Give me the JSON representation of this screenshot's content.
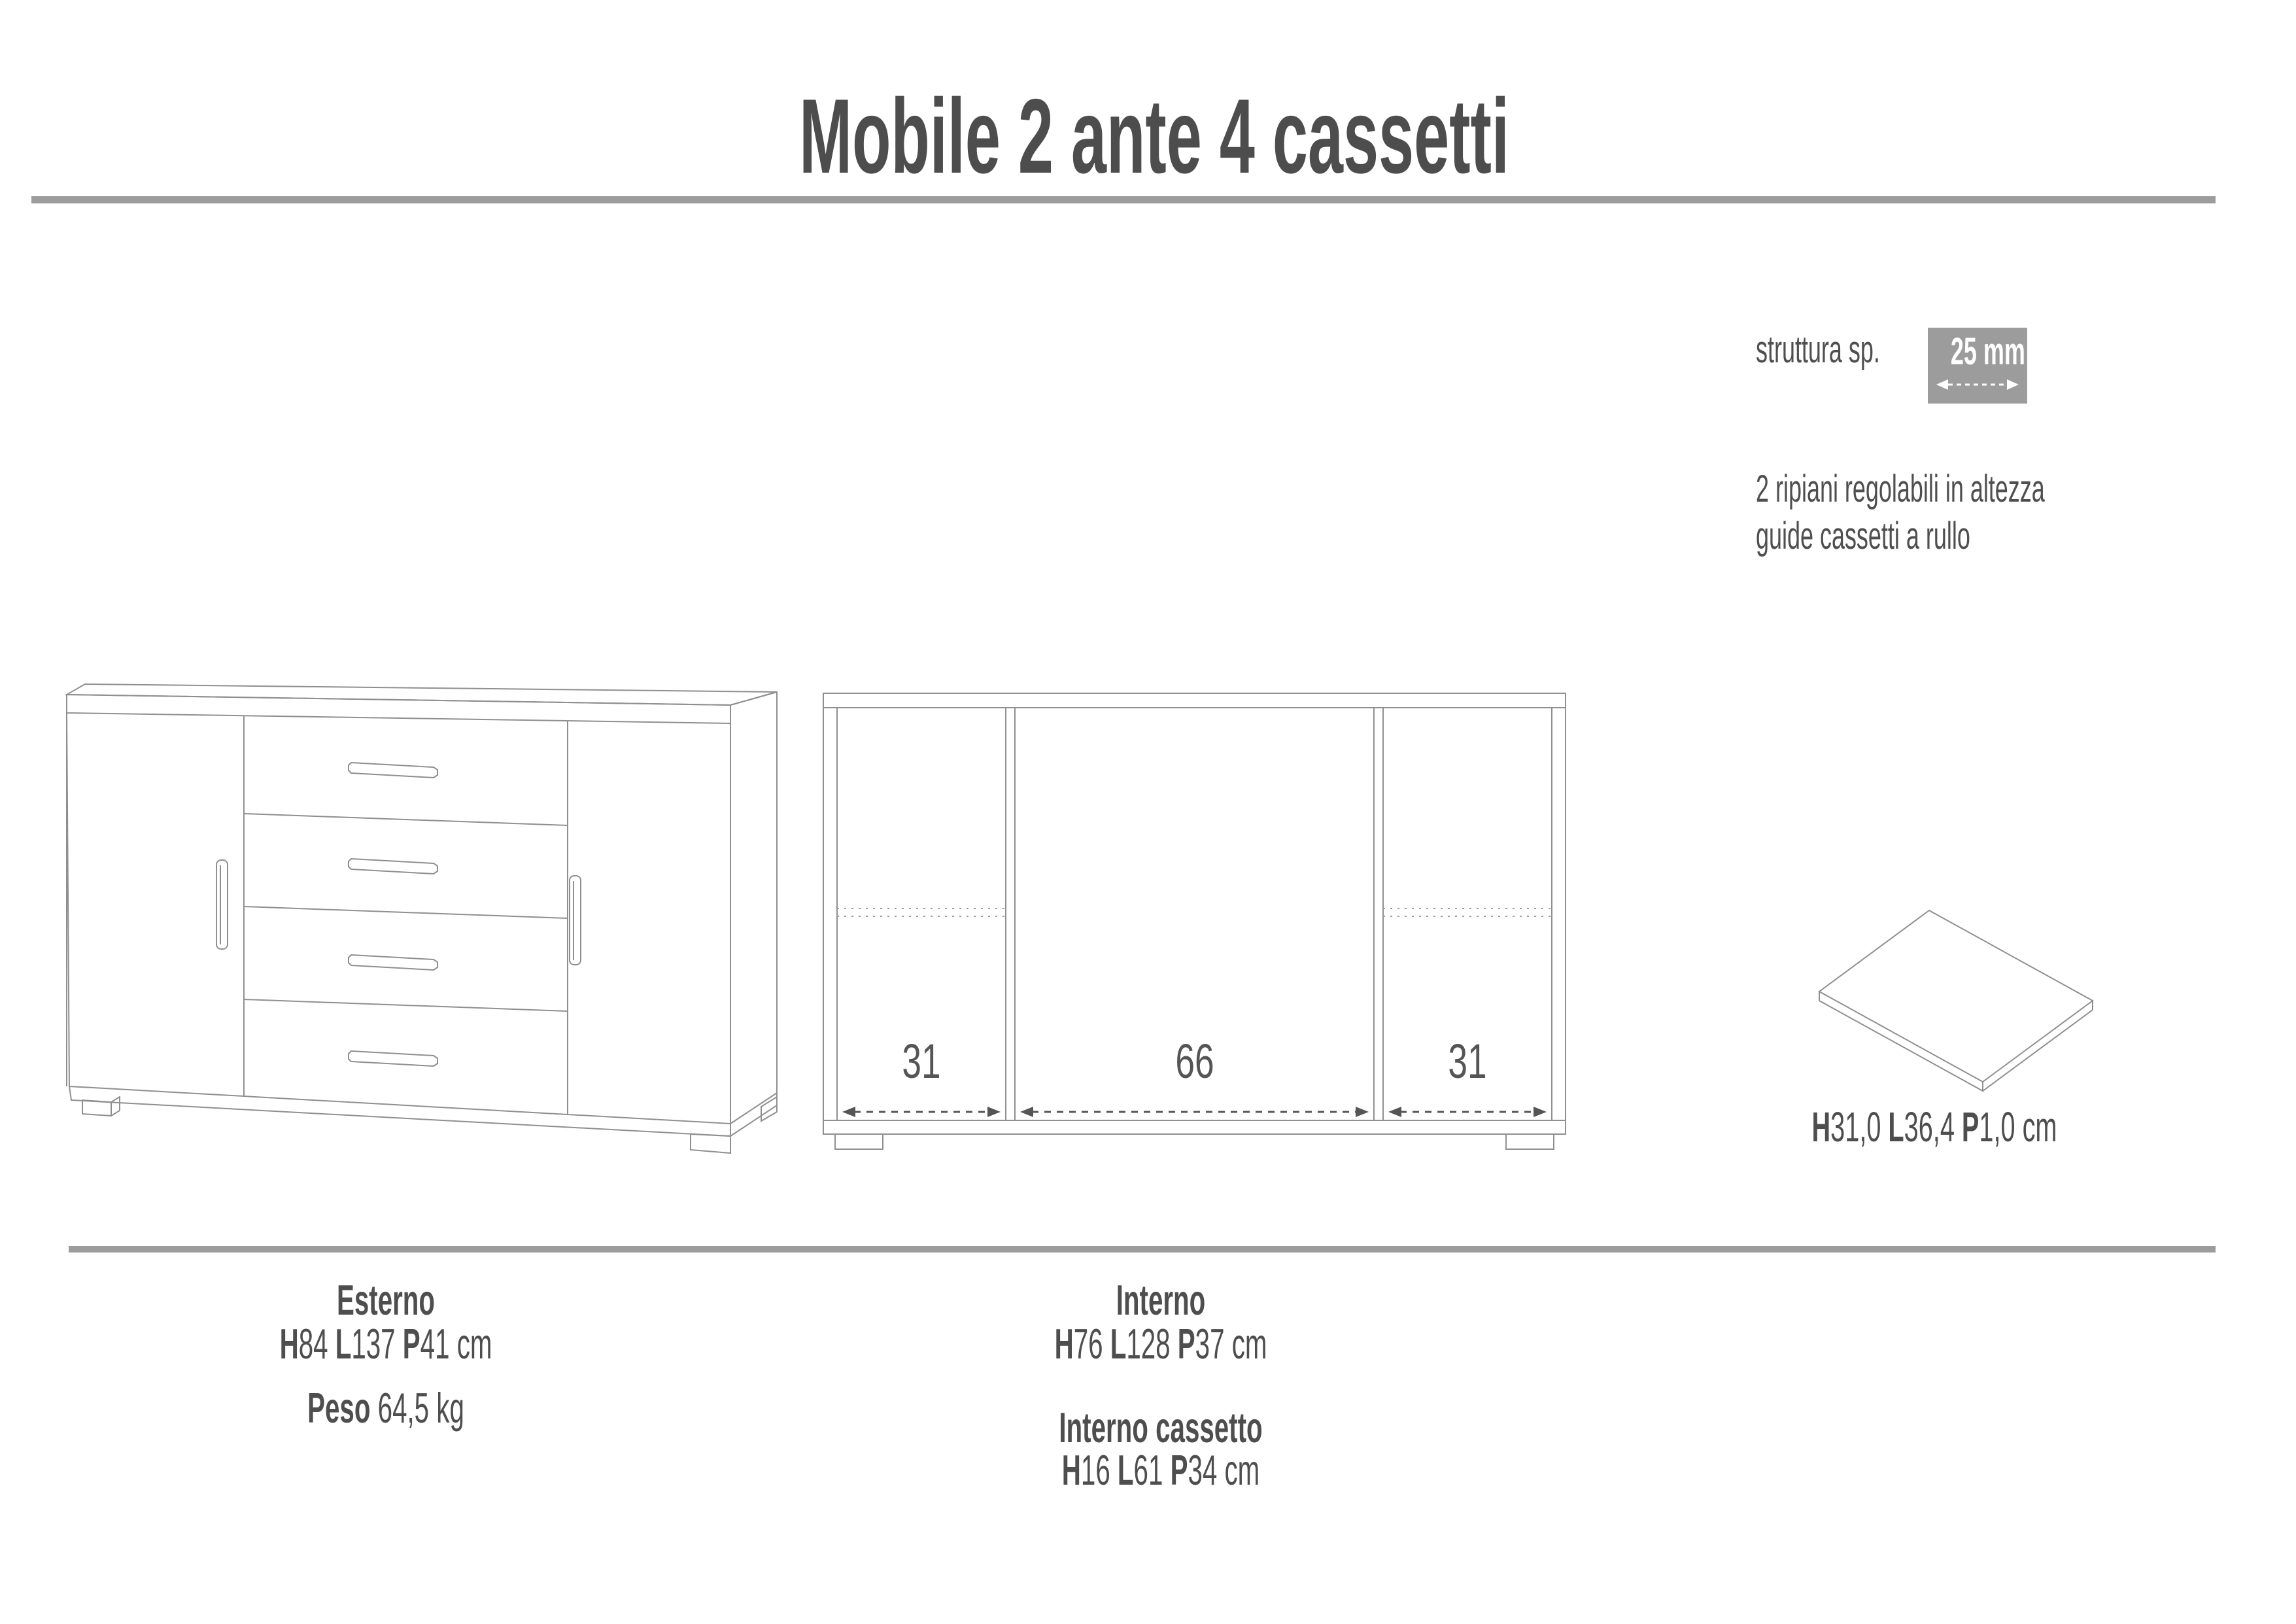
{
  "page": {
    "background": "#ffffff",
    "rule_color": "#9c9c9c",
    "text_color": "#4e4e4e",
    "drawing_line_color": "#8f8f8f",
    "badge_color": "#9c9c9c"
  },
  "title": "Mobile 2 ante 4 cassetti",
  "structure": {
    "label": "struttura sp.",
    "thickness": "25 mm"
  },
  "features": {
    "line1": "2 ripiani regolabili in altezza",
    "line2": "guide cassetti a rullo"
  },
  "internal_widths": [
    "31",
    "66",
    "31"
  ],
  "shelf": {
    "dims": [
      {
        "b": "H"
      },
      {
        "t": "31,0 "
      },
      {
        "b": "L"
      },
      {
        "t": "36,4 "
      },
      {
        "b": "P"
      },
      {
        "t": "1,0 cm"
      }
    ]
  },
  "specs": {
    "esterno": {
      "heading": "Esterno",
      "dims": [
        {
          "b": "H"
        },
        {
          "t": "84 "
        },
        {
          "b": "L"
        },
        {
          "t": "137 "
        },
        {
          "b": "P"
        },
        {
          "t": "41 cm"
        }
      ],
      "weight": [
        {
          "b": "Peso "
        },
        {
          "t": "64,5 kg"
        }
      ]
    },
    "interno": {
      "heading": "Interno",
      "dims": [
        {
          "b": "H"
        },
        {
          "t": "76 "
        },
        {
          "b": "L"
        },
        {
          "t": "128 "
        },
        {
          "b": "P"
        },
        {
          "t": "37 cm"
        }
      ]
    },
    "interno_cassetto": {
      "heading": "Interno cassetto",
      "dims": [
        {
          "b": "H"
        },
        {
          "t": "16 "
        },
        {
          "b": "L"
        },
        {
          "t": "61 "
        },
        {
          "b": "P"
        },
        {
          "t": "34 cm"
        }
      ]
    }
  }
}
